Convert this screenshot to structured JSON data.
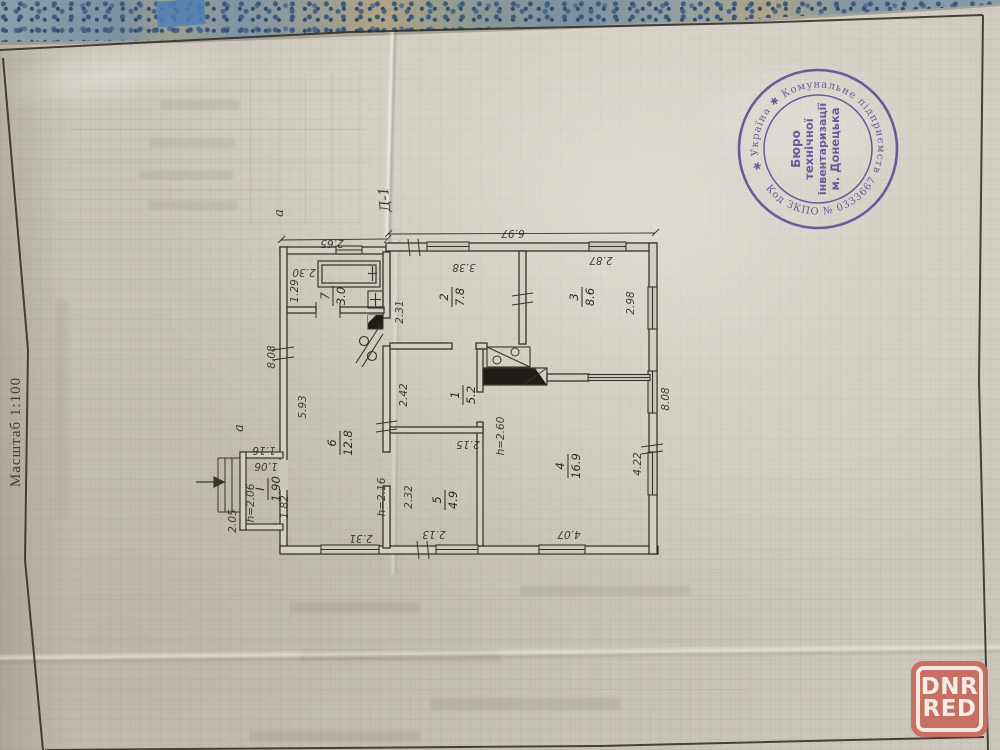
{
  "colors": {
    "stamp": "#453a8c",
    "watermark": "#c8675b",
    "paper": "#cbc7bc",
    "cover": "#7e93a2"
  },
  "document": {
    "scale_label": "Масштаб 1:100",
    "plan_mark": "Д-1",
    "annotation_a_top": "а",
    "annotation_a_left": "а",
    "stamp": {
      "ring_text_top": "✱ Україна ✱ Комунальне підприємство ✱",
      "ring_text_bottom": "Код ЗКПО № 03336670",
      "center_line1": "Бюро",
      "center_line2": "технічної",
      "center_line3": "інвентаризації",
      "center_line4": "м. Донецька"
    },
    "plan": {
      "rooms": [
        {
          "number": "1",
          "area": "5.2"
        },
        {
          "number": "2",
          "area": "7.8"
        },
        {
          "number": "3",
          "area": "8.6"
        },
        {
          "number": "4",
          "area": "16.9"
        },
        {
          "number": "5",
          "area": "4.9"
        },
        {
          "number": "6",
          "area": "12.8"
        },
        {
          "number": "7",
          "area": "3.0"
        },
        {
          "number": "I",
          "area": "1.90"
        }
      ],
      "dims": {
        "annex_width": "2.65",
        "main_width": "6.97",
        "side_left": "8.08",
        "side_right": "8.08",
        "bath_a": "2.30",
        "bath_b": "1.29",
        "room2_a": "2.31",
        "room2_b": "3.38",
        "room3_a": "2.87",
        "room3_b": "2.98",
        "room1_a": "2.42",
        "room1_b": "2.15",
        "room5_a": "2.32",
        "room5_b": "2.13",
        "room4_a": "4.07",
        "room4_b": "4.22",
        "room6_a": "5.93",
        "room6_b": "2.31",
        "porch_a": "1.16",
        "porch_b": "1.06",
        "porch_c": "2.05",
        "porch_d": "1.82",
        "height_hall": "h=2.16",
        "height_room4": "h=2.60",
        "height_porch": "h=2.06"
      }
    }
  },
  "watermark": {
    "line1": "DNR",
    "line2": "RED"
  }
}
